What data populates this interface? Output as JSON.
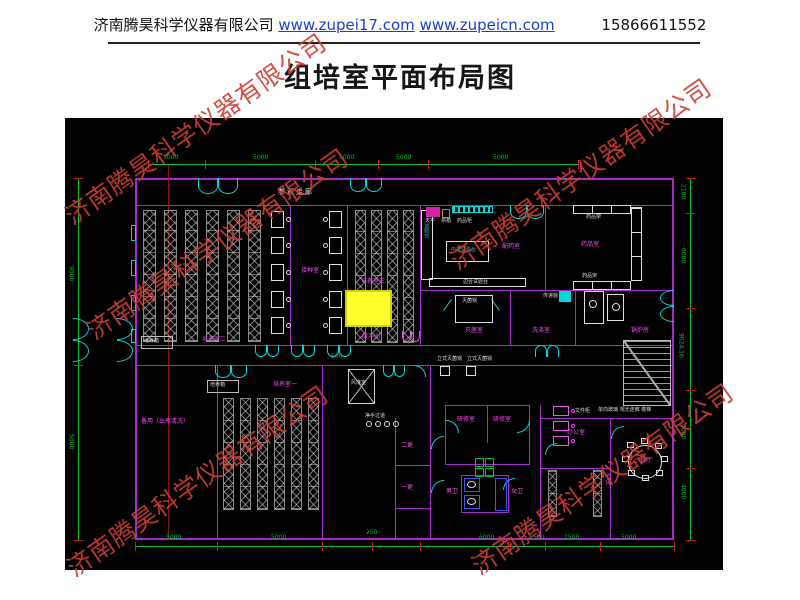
{
  "header": {
    "company": "济南腾昊科学仪器有限公司",
    "url1": "www.zupei17.com",
    "url2": "www.zupeicn.com",
    "phone": "15866611552"
  },
  "title": "组培室平面布局图",
  "watermark": "济南腾昊科学仪器有限公司",
  "plan": {
    "corridor": "参观走廊",
    "rooms": {
      "culture1": "培养室一",
      "culture2": "培养室二",
      "culture3": "培养室三",
      "inoculation": "接种室",
      "buffer": "缓冲间",
      "prep": "配药室",
      "medicine": "药品室",
      "sterilize": "灭菌室",
      "wash": "洗涤室",
      "boiler": "锅炉房",
      "spare": "备用（出瓶清洗）",
      "airshower": "风淋室",
      "handwash": "净手过道",
      "change1": "一更",
      "change2": "二更",
      "study1": "研修室",
      "study2": "研修室",
      "toilet_m": "男卫",
      "toilet_f": "女卫",
      "office": "办公室",
      "storage": "仓库",
      "dining": "小餐厅",
      "glass_corridor": "单向玻璃 观光走廊 楼梯"
    },
    "equipment": {
      "incubator": "培养箱",
      "central_bench": "中央试验台",
      "side_bench": "试验台",
      "long_bench": "边台试验台",
      "balance": "天平",
      "oven": "烘箱",
      "med_cabinet": "药品柜",
      "med_shelf": "药品架",
      "sterilizer": "灭菌锅",
      "autoclave": "立式灭菌锅",
      "pass_window": "传递窗",
      "file_cabinet": "文件柜"
    },
    "dims": {
      "top": [
        "5000",
        "5000",
        "5000",
        "5000",
        "5000"
      ],
      "left": [
        "9000",
        "5000"
      ],
      "right": [
        "2100",
        "6000",
        "9024.16",
        "4000",
        "4000"
      ],
      "bottom": [
        "5000",
        "5000",
        "250",
        "6000",
        "1500",
        "2500",
        "5000"
      ],
      "inner": [
        "500"
      ]
    },
    "colors": {
      "wall": "#a62cc9",
      "label": "#f04ef0",
      "dim": "#00c030",
      "door": "#00d8d8",
      "highlight": "#ffff2e",
      "tick": "#cc2020"
    }
  }
}
